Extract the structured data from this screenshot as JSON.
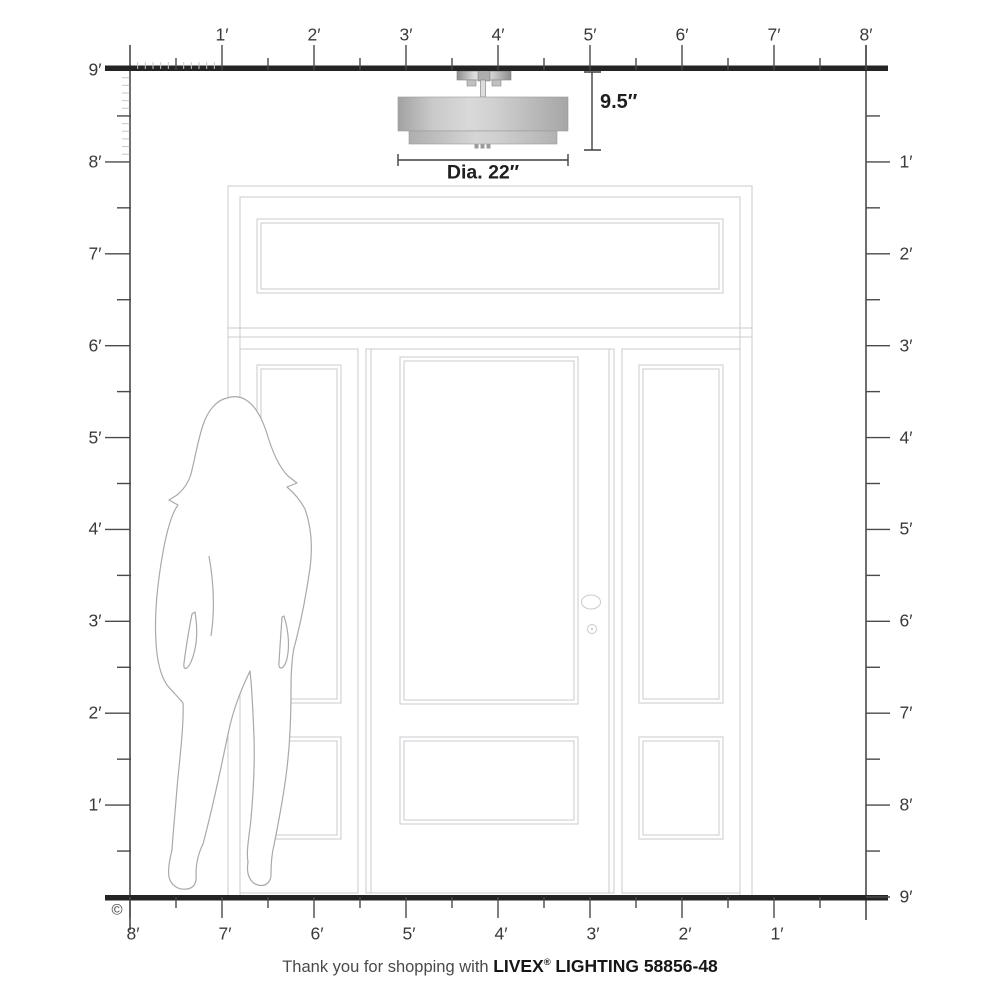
{
  "diagram": {
    "type": "product-scale-diagram",
    "subject": "drum semi-flush ceiling light shown above a door with sidelights and transom, woman silhouette for scale"
  },
  "fixture": {
    "height_label": "9.5″",
    "diameter_label": "Dia. 22″"
  },
  "rulers": {
    "unit": "feet",
    "top": {
      "labels": [
        "1′",
        "2′",
        "3′",
        "4′",
        "5′",
        "6′",
        "7′",
        "8′"
      ]
    },
    "left": {
      "labels": [
        "9′",
        "8′",
        "7′",
        "6′",
        "5′",
        "4′",
        "3′",
        "2′",
        "1′"
      ]
    },
    "right": {
      "labels": [
        "1′",
        "2′",
        "3′",
        "4′",
        "5′",
        "6′",
        "7′",
        "8′",
        "9′"
      ]
    },
    "bottom": {
      "labels": [
        "8′",
        "7′",
        "6′",
        "5′",
        "4′",
        "3′",
        "2′",
        "1′"
      ]
    }
  },
  "copyright": "©",
  "caption": {
    "prefix": "Thank you for shopping with",
    "brand": "LIVEX",
    "reg": "®",
    "suffix": "LIGHTING 58856-48"
  },
  "colors": {
    "ruler_line": "#242424",
    "tick": "#4a4a4a",
    "inch_tick": "#c8c8c8",
    "door_line": "#cbcbcf",
    "silhouette_line": "#a9a9a9",
    "shade_light": "#f0f0f0",
    "shade_dark": "#8e8e8e",
    "label_text": "#3a3a3a"
  }
}
